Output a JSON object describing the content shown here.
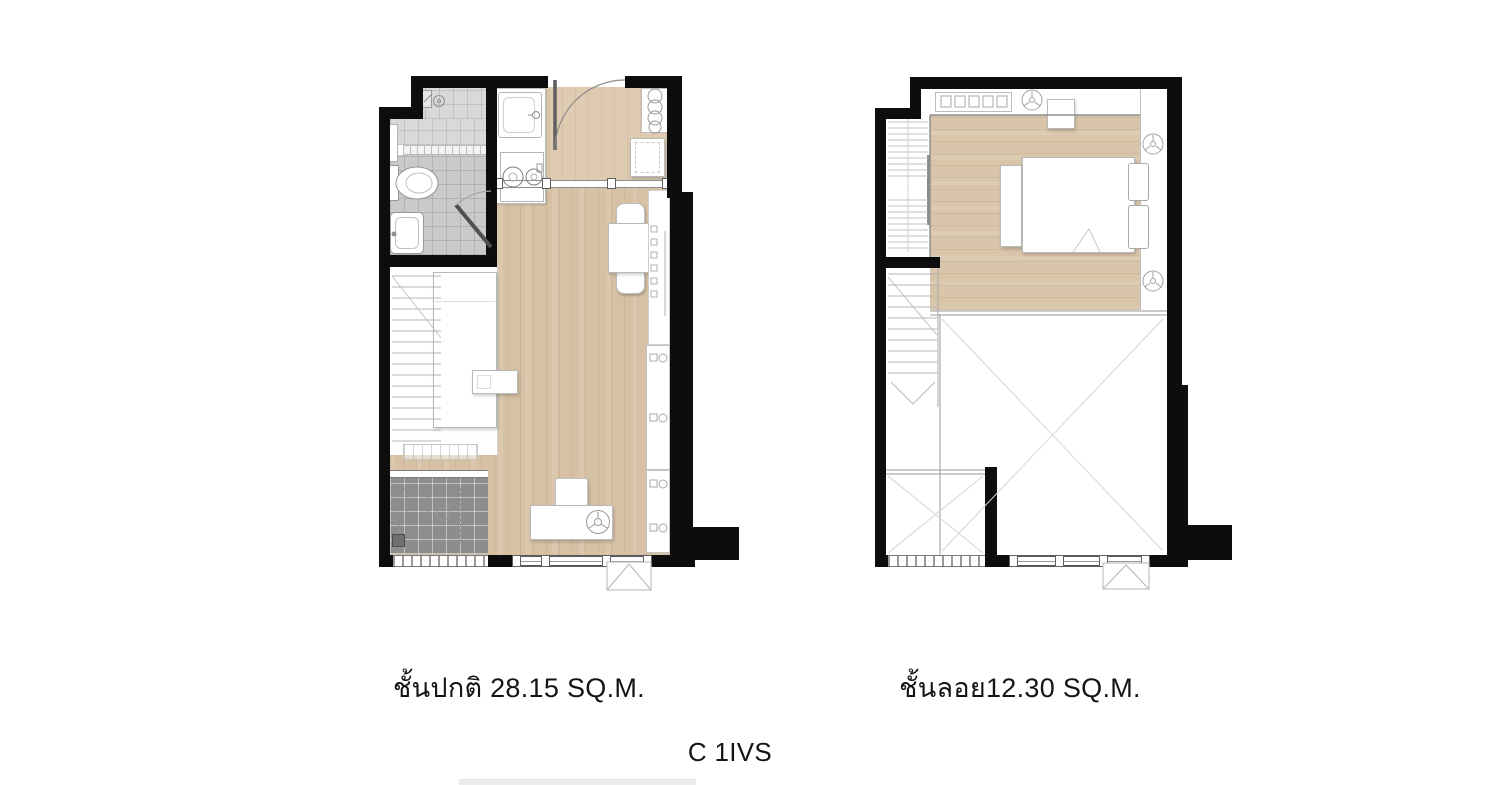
{
  "title_labels": {
    "left_plan": "ชั้นปกติ 28.15 SQ.M.",
    "right_plan": "ชั้นลอย12.30 SQ.M.",
    "unit_code": "C 1IVS"
  },
  "plan_meta": {
    "left_plan": {
      "floor_label": "ชั้นปกติ 28.15 SQ.M.",
      "area_sqm": "28.15"
    },
    "right_plan": {
      "floor_label": "ชั้นลอย12.30 SQ.M.",
      "area_sqm": "12.30"
    }
  },
  "colors": {
    "wall": "#0d0d0d",
    "wood_main": "#d6c1a5",
    "wood_light": "#decbb1",
    "wood_mezzanine": "#d9c5aa",
    "tile_bathroom": "#cacacc",
    "tile_shower": "#d9d9db",
    "tile_balcony": "#8d8d8f",
    "linework": "#b9b9b9",
    "text": "#141414"
  },
  "icon_legend": {
    "door_swing": "quarter-arc door swing",
    "bed": "double bed with pillows",
    "toilet": "toilet with tank",
    "basin": "wash basin",
    "shower": "shower head",
    "stove": "two-burner stove",
    "kitchen_sink": "kitchen sink",
    "dining_set": "table with two chairs",
    "desk_set": "desk with chair and stool",
    "stair": "staircase with treads",
    "wardrobe": "wardrobe with hangers",
    "fan": "ceiling fan",
    "ac_condenser": "air-conditioner condenser",
    "void": "double-height void (crossed lines)"
  }
}
